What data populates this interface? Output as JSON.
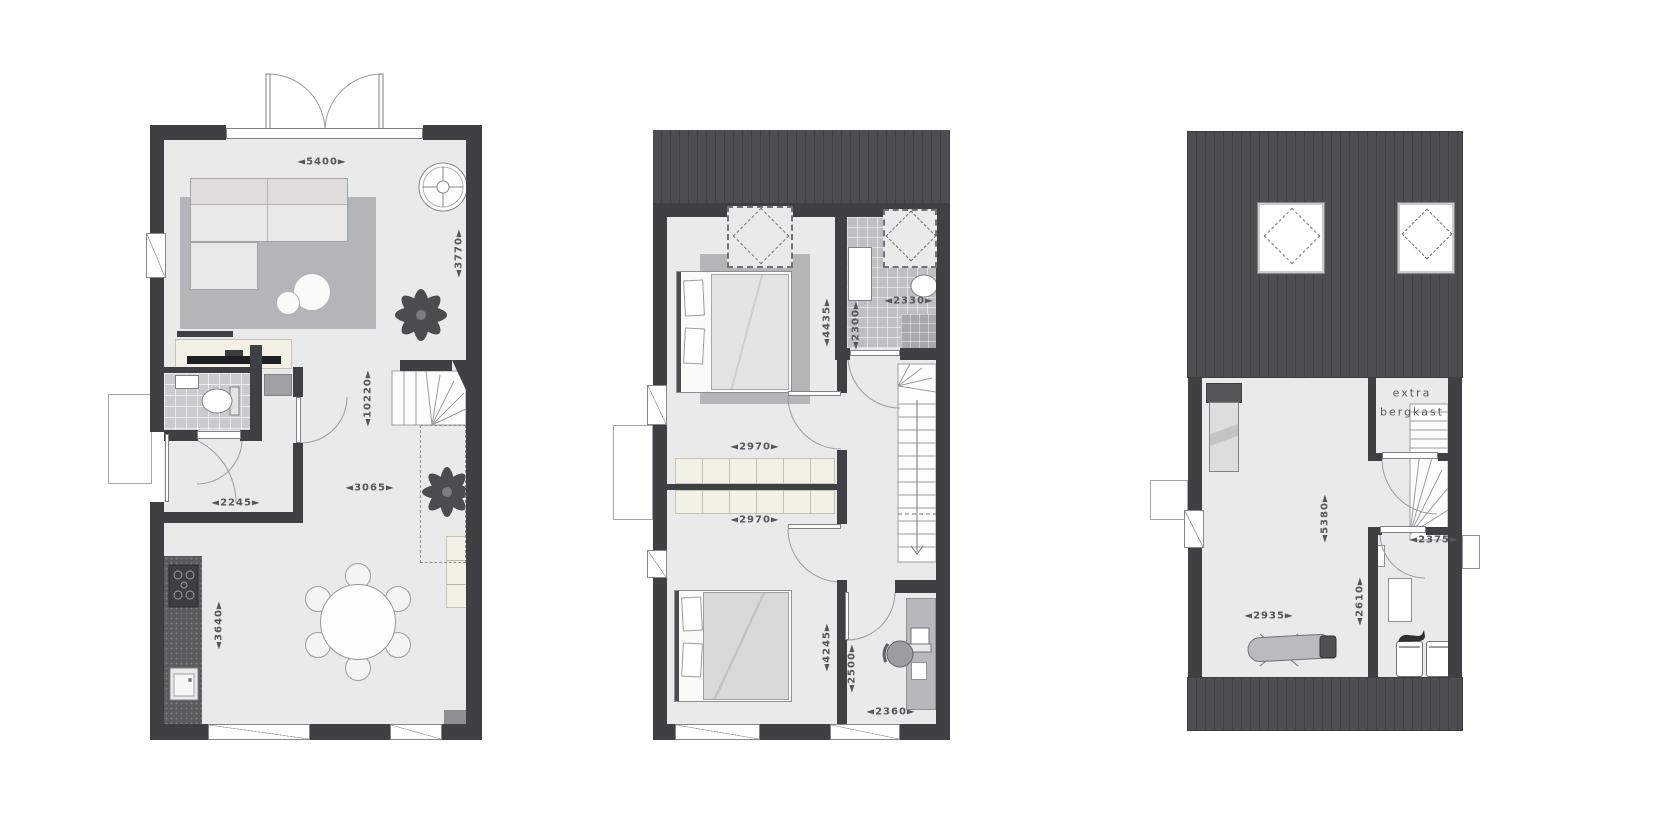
{
  "document": {
    "type": "architectural floor plans, three levels of a dwelling",
    "language": "Dutch"
  },
  "colors": {
    "wall": "#3e4144",
    "roof": "#4c4e51",
    "floor": "#e9eaea",
    "tile": "#c9ccce",
    "rug": "#b3b6b8",
    "cream": "#f3f1e5",
    "counter": "#595c5e",
    "line": "#9a9da0",
    "text": "#54575a"
  },
  "plans": {
    "ground_floor": {
      "name": "ground-floor",
      "dims": {
        "top_width": "◄5400►",
        "living_depth": "◄3770►",
        "total_depth": "◄10220►",
        "living_width": "◄3065►",
        "hall_width": "◄2245►",
        "kitchen_depth": "◄3640►"
      }
    },
    "first_floor": {
      "name": "first-floor",
      "dims": {
        "bedroom1_depth": "◄4435►",
        "bathroom_depth": "◄2300►",
        "bathroom_width": "◄2330►",
        "closet1_width": "◄2970►",
        "closet2_width": "◄2970►",
        "bedroom2_depth": "◄4245►",
        "landing_depth": "◄2500►",
        "study_width": "◄2360►"
      }
    },
    "attic": {
      "name": "attic",
      "room_labels": {
        "storage_line1": "extra",
        "storage_line2": "bergkast"
      },
      "dims": {
        "room_depth": "◄5380►",
        "room_width": "◄2935►",
        "laundry_depth": "◄2610►",
        "laundry_width": "◄2375►"
      }
    }
  }
}
